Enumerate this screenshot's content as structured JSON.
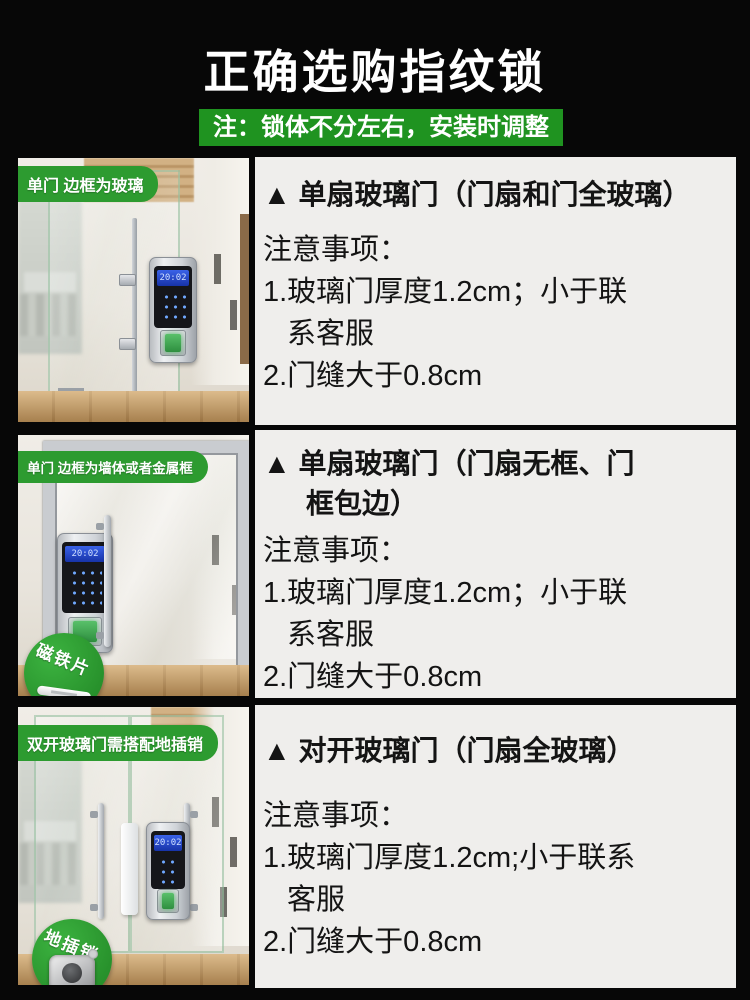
{
  "page": {
    "title": "正确选购指纹锁",
    "banner": "注：锁体不分左右，安装时调整"
  },
  "colors": {
    "background": "#070707",
    "banner_green": "#1f9320",
    "label_green": "#2d9b30",
    "badge_green": "#2f9e32",
    "panel_background": "#efeeec",
    "panel_text": "#141414",
    "lock_screen_blue": "#2a4cd0",
    "fingerprint_glow_green": "#45b45a",
    "wood_floor": "#c59b64"
  },
  "rows": [
    {
      "label": "单门 边框为玻璃",
      "lock_time": "20:02",
      "heading_line1": "▲ 单扇玻璃门（门扇和门全玻璃）",
      "notes_title": "注意事项：",
      "note1_line1": "1.玻璃门厚度1.2cm；小于联",
      "note1_line2": "系客服",
      "note2": "2.门缝大于0.8cm"
    },
    {
      "label": "单门 边框为墙体或者金属框",
      "badge": "磁铁片",
      "lock_time": "20:02",
      "heading_line1": "▲ 单扇玻璃门（门扇无框、门",
      "heading_line2": "框包边）",
      "notes_title": "注意事项：",
      "note1_line1": "1.玻璃门厚度1.2cm；小于联",
      "note1_line2": "系客服",
      "note2": "2.门缝大于0.8cm"
    },
    {
      "label": "双开玻璃门需搭配地插销",
      "badge": "地插销",
      "lock_time": "20:02",
      "heading_line1": "▲ 对开玻璃门（门扇全玻璃）",
      "notes_title": "注意事项：",
      "note1_line1": "1.玻璃门厚度1.2cm;小于联系",
      "note1_line2": "客服",
      "note2": "2.门缝大于0.8cm"
    }
  ]
}
